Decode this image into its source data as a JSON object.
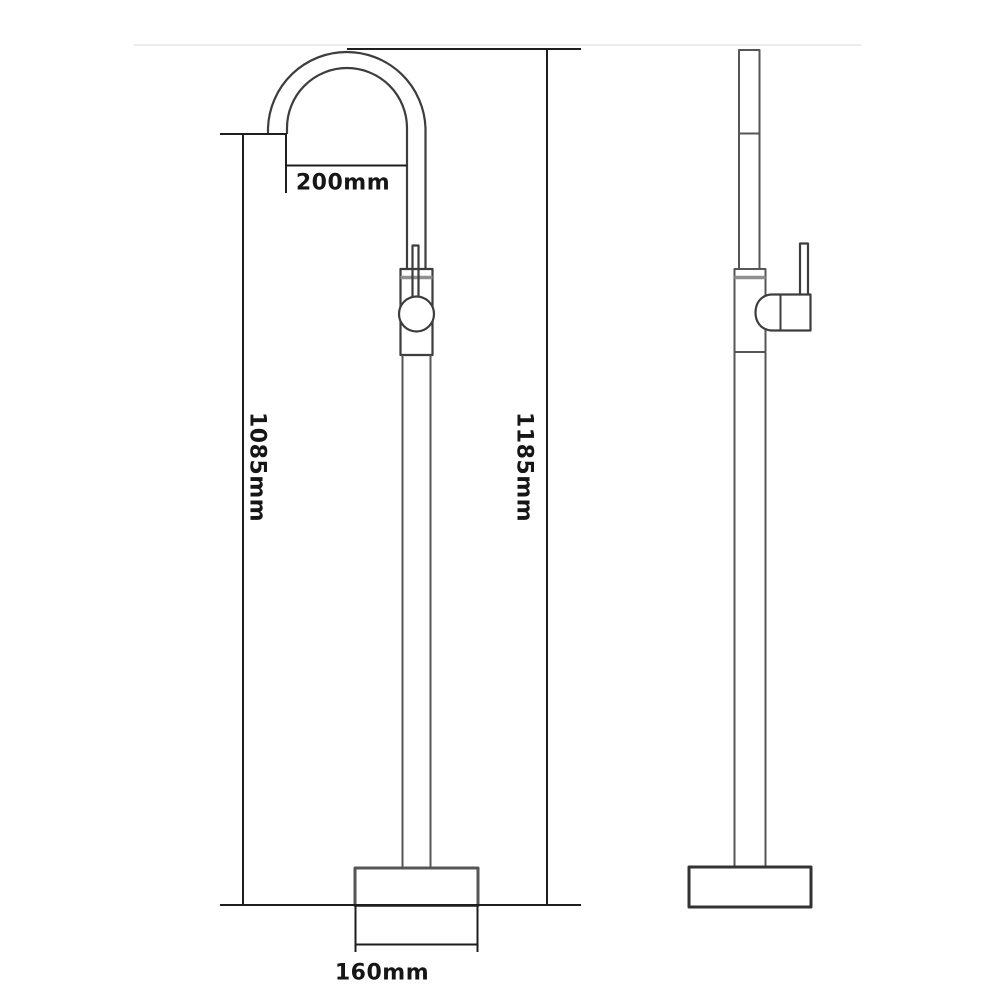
{
  "colors": {
    "outline": "#3d3d3d",
    "outline_light": "#565656",
    "accent_gray": "#909090",
    "dimension_line": "#1e1e1e",
    "label_text": "#161616",
    "background": "#ffffff",
    "faint_band": "#ececec"
  },
  "dimensions": [
    {
      "id": "spout-reach",
      "label": "200mm",
      "orientation": "horizontal"
    },
    {
      "id": "height-to-spout",
      "label": "1085mm",
      "orientation": "vertical"
    },
    {
      "id": "overall-height",
      "label": "1185mm",
      "orientation": "vertical"
    },
    {
      "id": "base-width",
      "label": "160mm",
      "orientation": "horizontal"
    }
  ]
}
